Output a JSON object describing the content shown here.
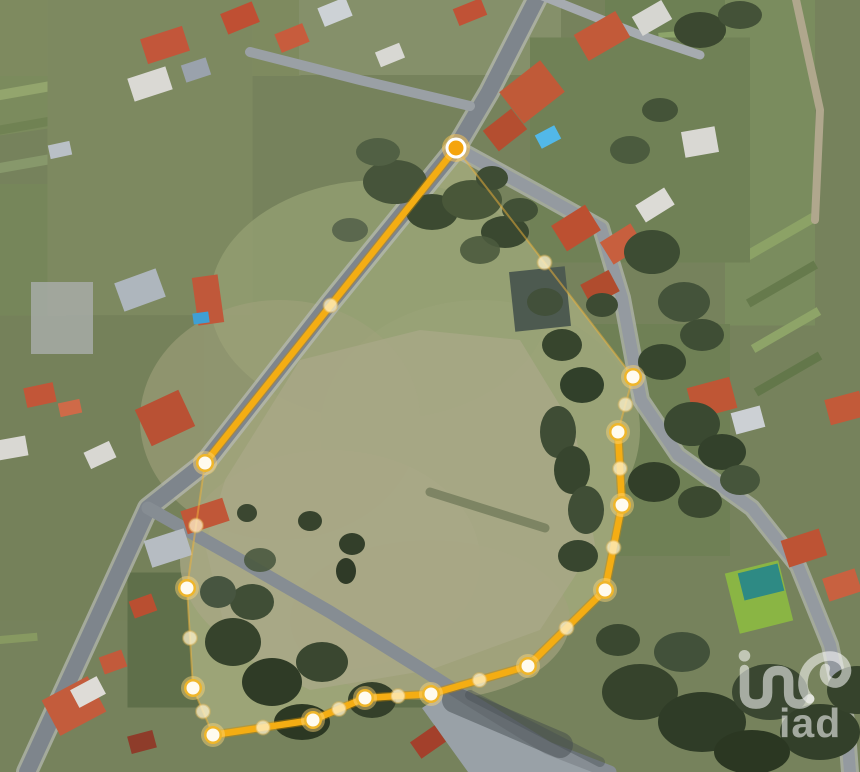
{
  "watermark": {
    "text": "iad",
    "color": "#ffffff",
    "opacity": 0.55
  },
  "overlay": {
    "line_color": "#f4ad13",
    "line_casing": "#c98a00",
    "faint_color": "#f2b43a",
    "vertex_ring": "#efb62b",
    "vertex_core": "#fffbef",
    "origin_core": "#f5a40c",
    "midpoint_fill": "#fff3cd",
    "origin": {
      "x": 456,
      "y": 148
    },
    "vertices": [
      [
        456,
        148
      ],
      [
        633,
        377
      ],
      [
        618,
        432
      ],
      [
        622,
        505
      ],
      [
        605,
        590
      ],
      [
        528,
        666
      ],
      [
        431,
        694
      ],
      [
        365,
        698
      ],
      [
        313,
        720
      ],
      [
        213,
        735
      ],
      [
        193,
        688
      ],
      [
        187,
        588
      ],
      [
        205,
        463
      ]
    ],
    "edges": [
      {
        "from": 0,
        "to": 1,
        "style": "faint"
      },
      {
        "from": 1,
        "to": 2,
        "style": "faint"
      },
      {
        "from": 2,
        "to": 3,
        "style": "thick"
      },
      {
        "from": 3,
        "to": 4,
        "style": "thick"
      },
      {
        "from": 4,
        "to": 5,
        "style": "thick"
      },
      {
        "from": 5,
        "to": 6,
        "style": "thick"
      },
      {
        "from": 6,
        "to": 7,
        "style": "thick"
      },
      {
        "from": 7,
        "to": 8,
        "style": "thick"
      },
      {
        "from": 8,
        "to": 9,
        "style": "thick"
      },
      {
        "from": 9,
        "to": 10,
        "style": "faint"
      },
      {
        "from": 10,
        "to": 11,
        "style": "faint"
      },
      {
        "from": 11,
        "to": 12,
        "style": "faint"
      },
      {
        "from": 12,
        "to": 0,
        "style": "thick"
      }
    ]
  },
  "scene": {
    "base": "#76825c",
    "patches": [
      [
        0,
        0,
        152,
        268,
        -8,
        "#7b8b5d",
        1
      ],
      [
        0,
        28,
        145,
        10,
        -10,
        "#8da065",
        1
      ],
      [
        0,
        60,
        145,
        9,
        -10,
        "#6d7f50",
        1
      ],
      [
        0,
        95,
        150,
        10,
        -10,
        "#93a56d",
        1
      ],
      [
        0,
        130,
        150,
        9,
        -10,
        "#708253",
        1
      ],
      [
        0,
        168,
        150,
        10,
        -10,
        "#87986b",
        1
      ],
      [
        0,
        205,
        150,
        9,
        -10,
        "#657748",
        1
      ],
      [
        0,
        255,
        132,
        130,
        0,
        "#8d9468",
        1
      ],
      [
        0,
        380,
        96,
        392,
        0,
        "#76865a",
        1
      ],
      [
        0,
        420,
        90,
        8,
        -5,
        "#8c9e66",
        1
      ],
      [
        0,
        452,
        90,
        8,
        -5,
        "#62744a",
        1
      ],
      [
        0,
        486,
        90,
        8,
        -5,
        "#90a26a",
        1
      ],
      [
        0,
        520,
        88,
        8,
        -5,
        "#697b4e",
        1
      ],
      [
        0,
        558,
        85,
        8,
        -5,
        "#8a9c64",
        1
      ],
      [
        0,
        598,
        80,
        8,
        -5,
        "#5f7146",
        1
      ],
      [
        0,
        640,
        75,
        8,
        -5,
        "#879961",
        1
      ],
      [
        148,
        0,
        305,
        152,
        0,
        "#7e8a5f",
        1
      ],
      [
        430,
        0,
        262,
        150,
        0,
        "#85906a",
        1
      ],
      [
        690,
        0,
        170,
        162,
        0,
        "#6d8054",
        1
      ],
      [
        705,
        74,
        86,
        90,
        -5,
        "#8da46a",
        1
      ],
      [
        770,
        158,
        90,
        335,
        0,
        "#7a8c5e",
        1
      ],
      [
        778,
        238,
        82,
        10,
        -30,
        "#8ca266",
        1
      ],
      [
        782,
        284,
        78,
        9,
        -30,
        "#667a4c",
        1
      ],
      [
        786,
        330,
        76,
        9,
        -30,
        "#8ea468",
        1
      ],
      [
        788,
        374,
        74,
        9,
        -30,
        "#63774a",
        1
      ],
      [
        640,
        150,
        220,
        225,
        0,
        "#708156",
        1
      ],
      [
        600,
        440,
        260,
        232,
        0,
        "#6f8055",
        1
      ],
      [
        96,
        468,
        215,
        305,
        0,
        "#75815a",
        1
      ],
      [
        300,
        640,
        345,
        135,
        0,
        "#5f6f4a",
        1
      ],
      [
        150,
        150,
        205,
        330,
        0,
        "#7d8960",
        1
      ],
      [
        62,
        318,
        62,
        72,
        0,
        "#a7aba7",
        0.85
      ]
    ],
    "grass_light": {
      "pts": [
        [
          225,
          480
        ],
        [
          300,
          360
        ],
        [
          420,
          330
        ],
        [
          520,
          340
        ],
        [
          575,
          430
        ],
        [
          595,
          545
        ],
        [
          540,
          630
        ],
        [
          430,
          670
        ],
        [
          310,
          690
        ],
        [
          230,
          650
        ],
        [
          205,
          545
        ]
      ],
      "color": "#aaa888",
      "opacity": 0.75
    },
    "soft": [
      [
        380,
        300,
        170,
        120,
        "#939f72",
        0.8
      ],
      [
        480,
        430,
        160,
        130,
        "#9aa377",
        0.7
      ],
      [
        330,
        560,
        150,
        110,
        "#a8a683",
        0.8
      ],
      [
        430,
        620,
        140,
        80,
        "#a3a17e",
        0.7
      ],
      [
        280,
        420,
        140,
        120,
        "#a0a27c",
        0.6
      ]
    ],
    "paved": [
      {
        "pts": [
          [
            446,
            692
          ],
          [
            602,
            772
          ],
          [
            468,
            772
          ],
          [
            422,
            708
          ]
        ],
        "color": "#99a1a7"
      }
    ],
    "roads": [
      {
        "pts": [
          [
            540,
            -8
          ],
          [
            489,
            92
          ],
          [
            456,
            148
          ],
          [
            330,
            303
          ],
          [
            205,
            463
          ],
          [
            148,
            508
          ],
          [
            27,
            772
          ]
        ],
        "w": 16,
        "color": "#7e858c",
        "casing": "#b8bbb6"
      },
      {
        "pts": [
          [
            148,
            508
          ],
          [
            240,
            560
          ],
          [
            330,
            612
          ],
          [
            420,
            668
          ],
          [
            470,
            700
          ],
          [
            548,
            748
          ],
          [
            610,
            772
          ]
        ],
        "w": 13,
        "color": "#868d93",
        "casing": null
      },
      {
        "pts": [
          [
            456,
            148
          ],
          [
            540,
            194
          ],
          [
            601,
            228
          ],
          [
            622,
            298
          ],
          [
            641,
            400
          ],
          [
            678,
            455
          ],
          [
            752,
            508
          ],
          [
            798,
            566
          ],
          [
            830,
            645
          ],
          [
            846,
            720
          ],
          [
            850,
            772
          ]
        ],
        "w": 12,
        "color": "#949aa0",
        "casing": "#b8bbb6"
      },
      {
        "pts": [
          [
            250,
            52
          ],
          [
            360,
            80
          ],
          [
            470,
            106
          ]
        ],
        "w": 10,
        "color": "#9aa0a5",
        "casing": null
      },
      {
        "pts": [
          [
            540,
            -5
          ],
          [
            640,
            35
          ],
          [
            700,
            55
          ]
        ],
        "w": 9,
        "color": "#a6abb0",
        "casing": null
      },
      {
        "pts": [
          [
            795,
            -5
          ],
          [
            820,
            110
          ],
          [
            815,
            220
          ]
        ],
        "w": 8,
        "color": "#b0a78d",
        "casing": null
      }
    ],
    "houses": [
      [
        165,
        45,
        44,
        26,
        -18,
        "#c2563a"
      ],
      [
        150,
        84,
        40,
        24,
        -18,
        "#dad9d4"
      ],
      [
        196,
        70,
        26,
        18,
        -18,
        "#9aa2ac"
      ],
      [
        60,
        150,
        22,
        14,
        -12,
        "#b9c0c6"
      ],
      [
        240,
        18,
        34,
        22,
        -22,
        "#bf4f33"
      ],
      [
        292,
        38,
        30,
        20,
        -22,
        "#c75c3d"
      ],
      [
        335,
        12,
        30,
        20,
        -22,
        "#cdd2d6"
      ],
      [
        390,
        55,
        26,
        16,
        -22,
        "#d8d8d3"
      ],
      [
        470,
        12,
        30,
        18,
        -22,
        "#c05236"
      ],
      [
        532,
        92,
        52,
        40,
        -38,
        "#c05a38"
      ],
      [
        505,
        130,
        36,
        26,
        -38,
        "#b44e30"
      ],
      [
        602,
        36,
        48,
        30,
        -30,
        "#c25a39"
      ],
      [
        652,
        18,
        34,
        22,
        -30,
        "#d6d6d1"
      ],
      [
        576,
        228,
        40,
        30,
        -32,
        "#bc5031"
      ],
      [
        622,
        244,
        36,
        26,
        -32,
        "#c75f3e"
      ],
      [
        655,
        205,
        34,
        20,
        -32,
        "#dcdbd6"
      ],
      [
        600,
        288,
        32,
        24,
        -28,
        "#b04c2e"
      ],
      [
        700,
        142,
        34,
        26,
        -10,
        "#d9d8d3"
      ],
      [
        712,
        398,
        44,
        32,
        -15,
        "#bf5635"
      ],
      [
        748,
        420,
        30,
        22,
        -15,
        "#ccd0d4"
      ],
      [
        845,
        408,
        36,
        26,
        -15,
        "#c25a39"
      ],
      [
        804,
        548,
        40,
        28,
        -18,
        "#bd5334"
      ],
      [
        842,
        585,
        34,
        24,
        -18,
        "#c86140"
      ],
      [
        208,
        300,
        26,
        48,
        -8,
        "#c0583a"
      ],
      [
        140,
        290,
        44,
        30,
        -20,
        "#aeb6bd"
      ],
      [
        40,
        395,
        30,
        20,
        -12,
        "#c25638"
      ],
      [
        70,
        408,
        22,
        14,
        -12,
        "#cf6a48"
      ],
      [
        165,
        418,
        48,
        40,
        -25,
        "#b95134"
      ],
      [
        100,
        455,
        28,
        18,
        -25,
        "#d8d7d2"
      ],
      [
        12,
        448,
        30,
        20,
        -10,
        "#d9d8d3"
      ],
      [
        205,
        516,
        44,
        24,
        -18,
        "#c05738"
      ],
      [
        168,
        548,
        42,
        28,
        -18,
        "#b6bcc2"
      ],
      [
        143,
        606,
        24,
        18,
        -20,
        "#b94f31"
      ],
      [
        113,
        662,
        24,
        18,
        -20,
        "#c25a3b"
      ],
      [
        74,
        706,
        52,
        40,
        -28,
        "#c35c3c"
      ],
      [
        88,
        692,
        30,
        20,
        -28,
        "#dedcd7"
      ],
      [
        142,
        742,
        26,
        18,
        -15,
        "#8e3c2a"
      ],
      [
        428,
        742,
        30,
        20,
        -35,
        "#a3402b"
      ],
      [
        540,
        299,
        56,
        60,
        -6,
        "#4d5a50"
      ]
    ],
    "pools": [
      [
        548,
        137,
        22,
        15,
        -28,
        "#52b8e8"
      ],
      [
        201,
        318,
        16,
        11,
        -8,
        "#3f9fd4"
      ]
    ],
    "court": {
      "x": 759,
      "y": 597,
      "w": 55,
      "h": 62,
      "rot": -14,
      "green": "#8ab544",
      "teal": "#2e8a84"
    },
    "streaks": [
      [
        430,
        492,
        545,
        528,
        9,
        "#5c6849",
        0.55
      ],
      [
        455,
        700,
        560,
        745,
        26,
        "#3e4549",
        0.45
      ],
      [
        470,
        695,
        600,
        762,
        10,
        "#454d52",
        0.4
      ]
    ],
    "trees": [
      [
        395,
        182,
        32,
        22,
        "#46543a",
        1
      ],
      [
        432,
        212,
        26,
        18,
        "#3c4a31",
        1
      ],
      [
        472,
        200,
        30,
        20,
        "#495739",
        1
      ],
      [
        505,
        232,
        24,
        16,
        "#3a4830",
        1
      ],
      [
        378,
        152,
        22,
        14,
        "#516044",
        1
      ],
      [
        350,
        230,
        18,
        12,
        "#55634a",
        0.9
      ],
      [
        492,
        178,
        16,
        12,
        "#3e4c34",
        1
      ],
      [
        480,
        250,
        20,
        14,
        "#4b5a3e",
        0.9
      ],
      [
        520,
        210,
        18,
        12,
        "#415036",
        1
      ],
      [
        545,
        302,
        18,
        14,
        "#42503a",
        1
      ],
      [
        562,
        345,
        20,
        16,
        "#37452d",
        1
      ],
      [
        582,
        385,
        22,
        18,
        "#31402a",
        1
      ],
      [
        602,
        305,
        16,
        12,
        "#3d4b33",
        1
      ],
      [
        558,
        432,
        18,
        26,
        "#3f4d35",
        1
      ],
      [
        572,
        470,
        18,
        24,
        "#37452e",
        1
      ],
      [
        586,
        510,
        18,
        24,
        "#404e36",
        1
      ],
      [
        578,
        556,
        20,
        16,
        "#38462f",
        1
      ],
      [
        652,
        252,
        28,
        22,
        "#3d4c33",
        1
      ],
      [
        684,
        302,
        26,
        20,
        "#44533a",
        1
      ],
      [
        662,
        362,
        24,
        18,
        "#37462e",
        1
      ],
      [
        702,
        335,
        22,
        16,
        "#3f4e35",
        1
      ],
      [
        692,
        424,
        28,
        22,
        "#3a4931",
        1
      ],
      [
        722,
        452,
        24,
        18,
        "#33412b",
        1
      ],
      [
        654,
        482,
        26,
        20,
        "#323f29",
        1
      ],
      [
        700,
        502,
        22,
        16,
        "#3b4930",
        1
      ],
      [
        740,
        480,
        20,
        15,
        "#46553b",
        1
      ],
      [
        630,
        150,
        20,
        14,
        "#47563c",
        0.9
      ],
      [
        660,
        110,
        18,
        12,
        "#3f4e35",
        0.9
      ],
      [
        700,
        30,
        26,
        18,
        "#3b4830",
        1
      ],
      [
        740,
        15,
        22,
        14,
        "#445238",
        1
      ],
      [
        247,
        513,
        10,
        9,
        "#3b4731",
        1
      ],
      [
        310,
        521,
        12,
        10,
        "#37432d",
        1
      ],
      [
        352,
        544,
        13,
        11,
        "#333f2a",
        1
      ],
      [
        346,
        571,
        10,
        13,
        "#2f3a27",
        1
      ],
      [
        233,
        642,
        28,
        24,
        "#36432c",
        1
      ],
      [
        272,
        682,
        30,
        24,
        "#2f3b26",
        1
      ],
      [
        322,
        662,
        26,
        20,
        "#3a4730",
        1
      ],
      [
        372,
        700,
        24,
        18,
        "#34402a",
        1
      ],
      [
        302,
        722,
        28,
        18,
        "#2c3823",
        1
      ],
      [
        252,
        602,
        22,
        18,
        "#404e36",
        1
      ],
      [
        218,
        592,
        18,
        16,
        "#475540",
        1
      ],
      [
        260,
        560,
        16,
        12,
        "#4a5940",
        0.9
      ],
      [
        618,
        640,
        22,
        16,
        "#3a4830",
        1
      ],
      [
        640,
        692,
        38,
        28,
        "#36432c",
        1
      ],
      [
        702,
        722,
        44,
        30,
        "#2f3c27",
        1
      ],
      [
        770,
        692,
        38,
        28,
        "#3a4731",
        1
      ],
      [
        820,
        732,
        40,
        28,
        "#33402a",
        1
      ],
      [
        682,
        652,
        28,
        20,
        "#42513a",
        1
      ],
      [
        752,
        752,
        38,
        22,
        "#2b3722",
        1
      ],
      [
        857,
        690,
        30,
        24,
        "#36432c",
        1
      ]
    ]
  }
}
